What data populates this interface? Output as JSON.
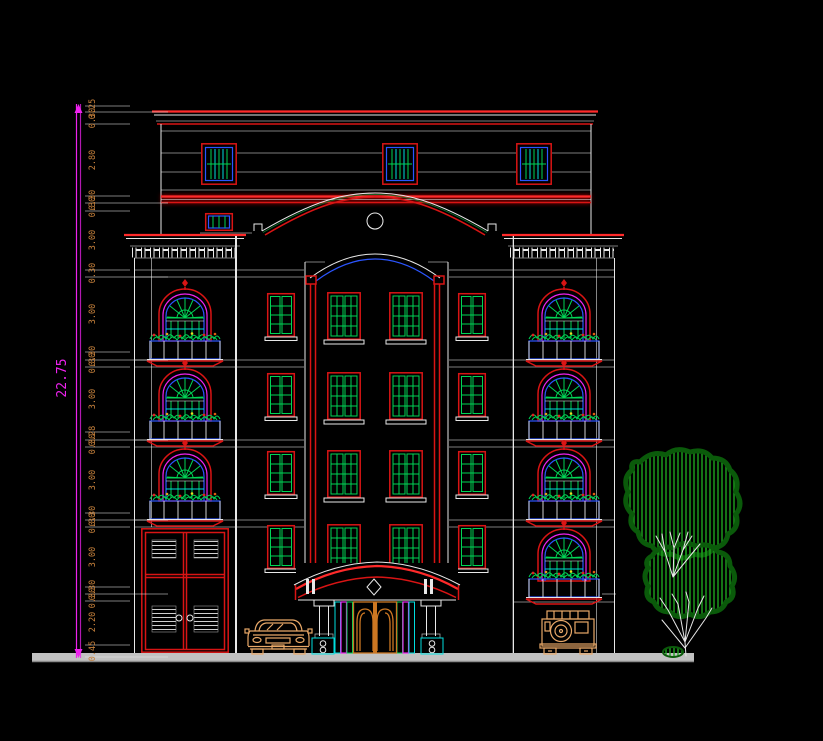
{
  "drawing": {
    "type": "cad-architectural-elevation",
    "background": "#000000",
    "colors": {
      "line_white": "#e8e8e8",
      "red": "#d91414",
      "bright_red": "#ff2a2a",
      "green": "#00d455",
      "tree_green": "#1ea31e",
      "tree_dark": "#0a5a0a",
      "cyan": "#00dede",
      "blue": "#2b55ff",
      "magenta": "#ee22ee",
      "orange_text": "#c8823c",
      "tan": "#e8a868",
      "door_orange": "#cc7722",
      "ground_gray": "#c2c2c2"
    },
    "dimension_column": {
      "total": {
        "label": "22.75",
        "x": 66,
        "y": 378
      },
      "labels": [
        {
          "y": 109,
          "label": "0.25"
        },
        {
          "y": 118,
          "label": "0.30"
        },
        {
          "y": 160,
          "label": "2.80"
        },
        {
          "y": 200,
          "label": "0.30"
        },
        {
          "y": 207,
          "label": "0.30"
        },
        {
          "y": 240,
          "label": "3.00"
        },
        {
          "y": 273,
          "label": "0.30"
        },
        {
          "y": 314,
          "label": "3.00"
        },
        {
          "y": 356,
          "label": "0.30"
        },
        {
          "y": 363,
          "label": "0.30"
        },
        {
          "y": 399,
          "label": "3.00"
        },
        {
          "y": 436,
          "label": "0.28"
        },
        {
          "y": 444,
          "label": "0.30"
        },
        {
          "y": 480,
          "label": "3.00"
        },
        {
          "y": 516,
          "label": "0.30"
        },
        {
          "y": 523,
          "label": "0.30"
        },
        {
          "y": 557,
          "label": "3.00"
        },
        {
          "y": 590,
          "label": "0.30"
        },
        {
          "y": 598,
          "label": "0.30"
        },
        {
          "y": 622,
          "label": "2.20"
        },
        {
          "y": 651,
          "label": "0.45"
        }
      ],
      "ticks": [
        {
          "y": 106,
          "major": false
        },
        {
          "y": 112,
          "major": true
        },
        {
          "y": 124,
          "major": false
        },
        {
          "y": 196,
          "major": false
        },
        {
          "y": 203,
          "major": true
        },
        {
          "y": 211,
          "major": false
        },
        {
          "y": 270,
          "major": false
        },
        {
          "y": 277,
          "major": true
        },
        {
          "y": 352,
          "major": false
        },
        {
          "y": 360,
          "major": true
        },
        {
          "y": 367,
          "major": false
        },
        {
          "y": 432,
          "major": false
        },
        {
          "y": 440,
          "major": true
        },
        {
          "y": 447,
          "major": false
        },
        {
          "y": 513,
          "major": false
        },
        {
          "y": 520,
          "major": true
        },
        {
          "y": 527,
          "major": false
        },
        {
          "y": 587,
          "major": false
        },
        {
          "y": 594,
          "major": true
        },
        {
          "y": 601,
          "major": false
        },
        {
          "y": 645,
          "major": false
        },
        {
          "y": 657,
          "major": true
        }
      ]
    }
  }
}
